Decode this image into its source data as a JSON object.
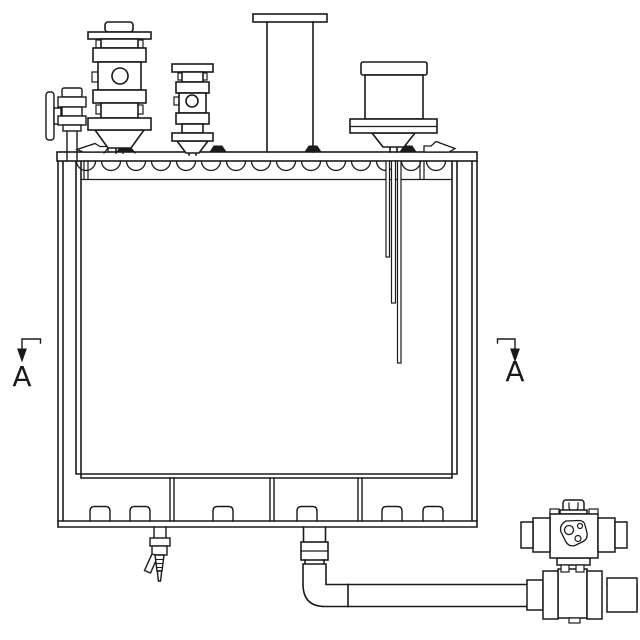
{
  "drawing": {
    "background_color": "#ffffff",
    "line_color": "#1a1a1a",
    "section_markers": {
      "left": {
        "label": "A"
      },
      "right": {
        "label": "A"
      }
    },
    "components": {
      "tank": "rectangular-process-tank",
      "lid": "clamped-lid-with-scalloped-gasket",
      "top_fittings": [
        "side-flange-port-fitting",
        "relief-valve-large",
        "relief-valve-small",
        "riser-pipe-with-top-flange",
        "filter-canister-on-flange"
      ],
      "internals": [
        "dip-tube-short",
        "dip-tube-medium",
        "dip-tube-long"
      ],
      "bottom_fittings": [
        "hose-bib-drain-valve",
        "outlet-elbow-pipe",
        "actuated-ball-valve"
      ]
    }
  }
}
